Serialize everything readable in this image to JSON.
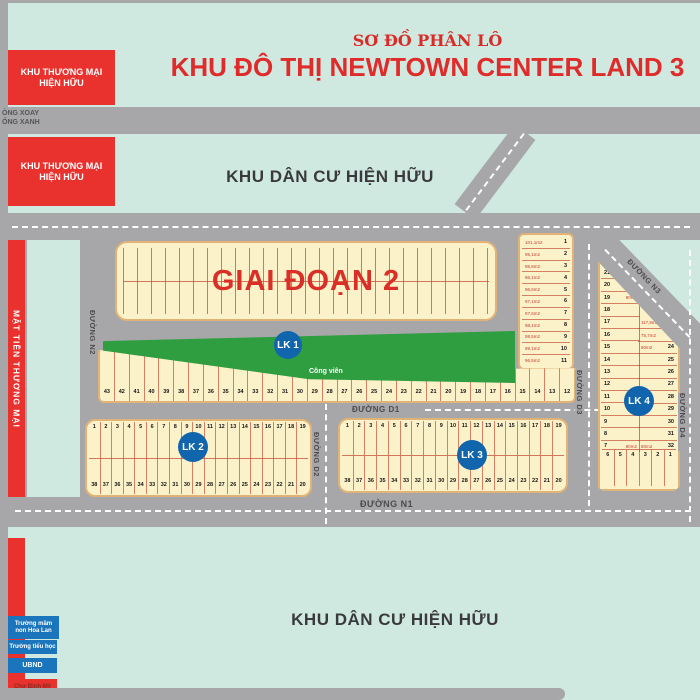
{
  "title": {
    "line1": "SƠ ĐỒ PHÂN LÔ",
    "line2": "KHU ĐÔ THỊ NEWTOWN CENTER LAND 3"
  },
  "labels": {
    "khu_thuong_mai_l1": "KHU THƯƠNG MẠI",
    "khu_thuong_mai_l2": "HIỆN HỮU",
    "khu_dan_cu": "KHU DÂN CƯ HIỆN HỮU",
    "mat_tien": "MẶT TIỀN THƯƠNG MẠI",
    "vong_xoay": "ÒNG XOAY",
    "cong_xanh": "ỐNG XANH",
    "giai_doan": "GIAI ĐOẠN 2",
    "cong_vien": "Công viên"
  },
  "roads": {
    "n1": "ĐƯỜNG N1",
    "n2": "ĐƯỜNG N2",
    "n3": "ĐƯỜNG N3",
    "d1": "ĐƯỜNG D1",
    "d2": "ĐƯỜNG D2",
    "d3": "ĐƯỜNG D3",
    "d4": "ĐƯỜNG D4"
  },
  "badges": {
    "lk1": "LK 1",
    "lk2": "LK 2",
    "lk3": "LK 3",
    "lk4": "LK 4"
  },
  "facilities": [
    {
      "label": "Trường mầm non Hoa Lan"
    },
    {
      "label": "Trường tiểu học"
    },
    {
      "label": "UBND"
    },
    {
      "label": "Chợ Bình Mỹ"
    }
  ],
  "lots": {
    "strip_col": [
      {
        "n": "1",
        "a": "101,1m2"
      },
      {
        "n": "2",
        "a": "95,1m2"
      },
      {
        "n": "3",
        "a": "95,8m2"
      },
      {
        "n": "4",
        "a": "96,1m2"
      },
      {
        "n": "5",
        "a": "96,6m2"
      },
      {
        "n": "6",
        "a": "97,1m2"
      },
      {
        "n": "7",
        "a": "97,6m2"
      },
      {
        "n": "8",
        "a": "98,1m2"
      },
      {
        "n": "9",
        "a": "98,5m2"
      },
      {
        "n": "10",
        "a": "99,1m2"
      },
      {
        "n": "11",
        "a": "96,5m2"
      }
    ],
    "lk1_row": [
      "43",
      "42",
      "41",
      "40",
      "39",
      "38",
      "37",
      "36",
      "35",
      "34",
      "33",
      "32",
      "31",
      "30",
      "29",
      "28",
      "27",
      "26",
      "25",
      "24",
      "23",
      "22",
      "21",
      "20",
      "19",
      "18",
      "17",
      "16",
      "15",
      "14",
      "13",
      "12"
    ],
    "row_1_19": [
      "1",
      "2",
      "3",
      "4",
      "5",
      "6",
      "7",
      "8",
      "9",
      "10",
      "11",
      "12",
      "13",
      "14",
      "15",
      "16",
      "17",
      "18",
      "19"
    ],
    "row_38_20": [
      "38",
      "37",
      "36",
      "35",
      "34",
      "33",
      "32",
      "31",
      "30",
      "29",
      "28",
      "27",
      "26",
      "25",
      "24",
      "23",
      "22",
      "21",
      "20"
    ],
    "lk4_left": [
      {
        "n": "21",
        "a": "128,2m2"
      },
      {
        "n": "20",
        "a": ""
      },
      {
        "n": "19",
        "a": "80m2"
      },
      {
        "n": "18",
        "a": ""
      },
      {
        "n": "17",
        "a": ""
      },
      {
        "n": "16",
        "a": ""
      },
      {
        "n": "15",
        "a": ""
      },
      {
        "n": "14",
        "a": ""
      },
      {
        "n": "13",
        "a": ""
      },
      {
        "n": "12",
        "a": ""
      },
      {
        "n": "11",
        "a": ""
      },
      {
        "n": "10",
        "a": ""
      },
      {
        "n": "9",
        "a": ""
      },
      {
        "n": "8",
        "a": ""
      },
      {
        "n": "7",
        "a": "80m2"
      }
    ],
    "lk4_right": [
      {
        "n": "22",
        "a": "117,8m2"
      },
      {
        "n": "23",
        "a": "75,7m2"
      },
      {
        "n": "24",
        "a": "80m2"
      },
      {
        "n": "25",
        "a": ""
      },
      {
        "n": "26",
        "a": ""
      },
      {
        "n": "27",
        "a": ""
      },
      {
        "n": "28",
        "a": ""
      },
      {
        "n": "29",
        "a": ""
      },
      {
        "n": "30",
        "a": ""
      },
      {
        "n": "31",
        "a": ""
      },
      {
        "n": "32",
        "a": "80m2"
      }
    ],
    "lk4_bottom": [
      "6",
      "5",
      "4",
      "3",
      "2",
      "1"
    ]
  },
  "colors": {
    "background_mint": "#cfe9e1",
    "road_gray": "#a7a7a9",
    "block_cream": "#fcf2ca",
    "block_border": "#e2b377",
    "lot_line_red": "#c44e37",
    "park_green": "#2f9e41",
    "badge_blue": "#1065ad",
    "highlight_red": "#e9312d",
    "facility_blue": "#1b75bc",
    "title_red": "#e02b2b"
  }
}
